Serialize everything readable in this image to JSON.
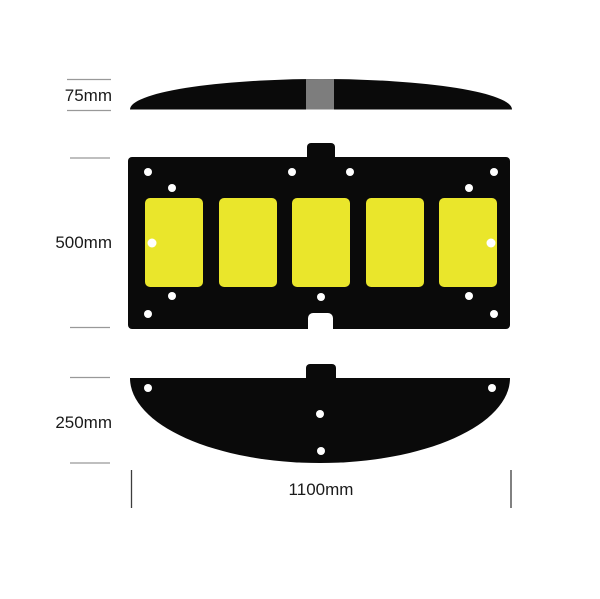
{
  "diagram": {
    "views": {
      "side_profile": {
        "label": "75mm"
      },
      "plan": {
        "label": "500mm",
        "panel_count": 5,
        "hole_count": 13
      },
      "end_profile": {
        "label": "250mm",
        "hole_count": 4
      },
      "length": {
        "label": "1100mm"
      }
    },
    "colors": {
      "body": "#0a0a0a",
      "panel": "#eae62b",
      "connector": "#7d7d7d",
      "hole": "#ffffff",
      "dim_line": "#999999",
      "dim_tick": "#3d3d3d",
      "text": "#1a1a1a",
      "background": "#ffffff"
    }
  }
}
